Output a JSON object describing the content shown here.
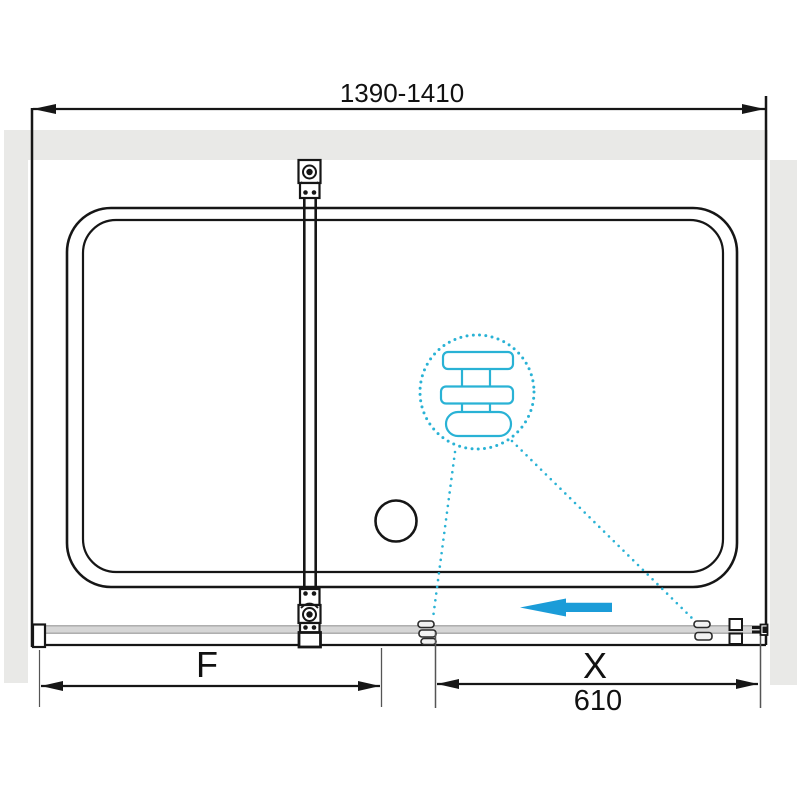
{
  "colors": {
    "accent": "#29b2d5",
    "arrow_blue": "#1b9cd8",
    "wall_gray": "#e9e9e7",
    "rail_gray": "#d6d6d6",
    "line_black": "#161616"
  },
  "dimensions": {
    "overall_width": {
      "label": "1390-1410"
    },
    "fixed_panel": {
      "label": "F"
    },
    "sliding_door": {
      "label": "X",
      "value": "610"
    }
  },
  "icons": {
    "top_wall_bracket": "glass-clamp",
    "bottom_wall_bracket": "glass-clamp",
    "towel_bracket_detail": "towel-bar-cross-section",
    "drain": "drain-circle",
    "slide_direction_arrow": "left-arrow",
    "door_rollers": "roller-pair",
    "door_stopper": "square-stopper-pair",
    "wall_bracket_right": "wall-fixing-profile"
  }
}
